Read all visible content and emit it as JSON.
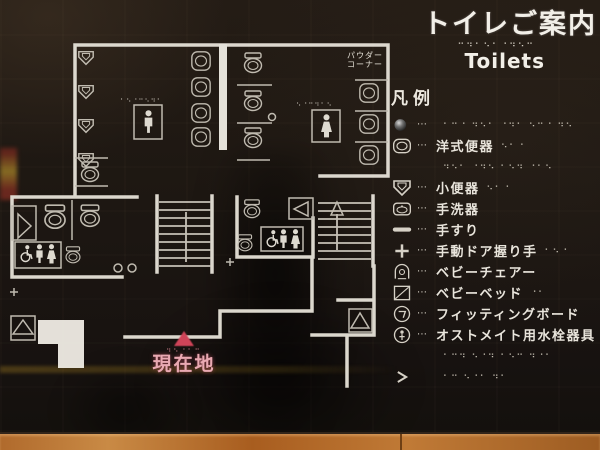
{
  "title": {
    "ja": "トイレご案内",
    "en": "Toilets",
    "braille": "⠒⠲⠂⠢⠂⠐⠲⠢⠒"
  },
  "legend": {
    "heading": "凡例",
    "items": [
      {
        "icon": "sphere",
        "dots": "⋯",
        "label": "",
        "braille": "⠂⠒⠐ ⠲⠢⠂ ⠐⠲⠂ ⠢⠒⠐ ⠲⠢"
      },
      {
        "icon": "western-toilet",
        "dots": "⋯",
        "label": "洋式便器",
        "braille": "⠢⠂⠐"
      },
      {
        "icon": "",
        "dots": "",
        "label": "",
        "braille": "⠲⠢⠂ ⠐⠲⠢ ⠂⠢⠲ ⠐⠂⠢"
      },
      {
        "icon": "urinal",
        "dots": "⋯",
        "label": "小便器",
        "braille": "⠢⠂⠐"
      },
      {
        "icon": "sink",
        "dots": "⋯",
        "label": "手洗器",
        "braille": ""
      },
      {
        "icon": "handrail",
        "dots": "⋯",
        "label": "手すり",
        "braille": ""
      },
      {
        "icon": "door-grip",
        "dots": "⋯",
        "label": "手動ドア握り手",
        "braille": "⠂⠢⠐"
      },
      {
        "icon": "baby-chair",
        "dots": "⋯",
        "label": "ベビーチェアー",
        "braille": ""
      },
      {
        "icon": "baby-bed",
        "dots": "⋯",
        "label": "ベビーベッド",
        "braille": "⠐⠂"
      },
      {
        "icon": "fitting-board",
        "dots": "⋯",
        "label": "フィッティングボード",
        "braille": ""
      },
      {
        "icon": "ostomate",
        "dots": "⋯",
        "label": "オストメイト用水栓器具",
        "braille": ""
      },
      {
        "icon": "",
        "dots": "",
        "label": "",
        "braille": "⠂⠒⠲ ⠢⠐⠲ ⠂⠢⠒ ⠲⠐⠂"
      },
      {
        "icon": "chevron",
        "dots": "",
        "label": "",
        "braille": "⠂⠒ ⠢⠐⠂ ⠲⠂"
      }
    ]
  },
  "map": {
    "powder_line1": "パウダー",
    "powder_line2": "コーナー",
    "current_location_label": "現在地",
    "current_location_braille": "⠲⠢⠐⠂⠒",
    "mens_braille": "⠂⠢⠐⠒⠢⠲⠂",
    "womens_braille": "⠢⠐⠒⠲⠂⠢"
  },
  "colors": {
    "accent_pink": "#e9a9b2",
    "marker_red": "#cf4458",
    "wall_white": "#e6e2d8",
    "wood_frame": "#b06a2c"
  }
}
